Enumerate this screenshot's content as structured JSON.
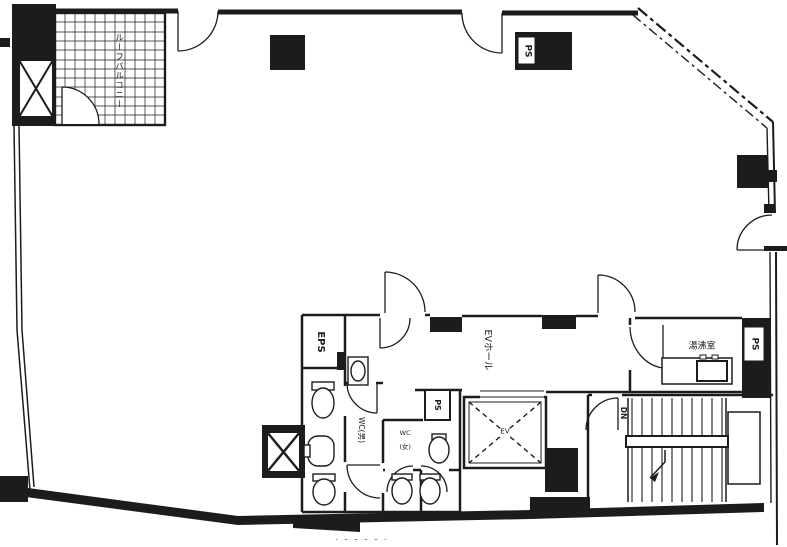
{
  "page": {
    "background": "#ffffff",
    "ink": "#1c1c1c",
    "kind": "architectural floor plan (black ink line drawing)"
  },
  "labels": {
    "roof_balcony": "ルーフバルコニー",
    "ps_top": "PS",
    "eps": "EPS",
    "ev_hall": "EVホール",
    "ev": "EV",
    "ps_core": "PS",
    "wc_male": "WC(男)",
    "wc_female_line1": "WC",
    "wc_female_line2": "(女)",
    "kitchenette": "湯沸室",
    "ps_right": "PS",
    "dn": "DN",
    "bottom_fragment": "⌒⌒⌒⌒⌒"
  }
}
